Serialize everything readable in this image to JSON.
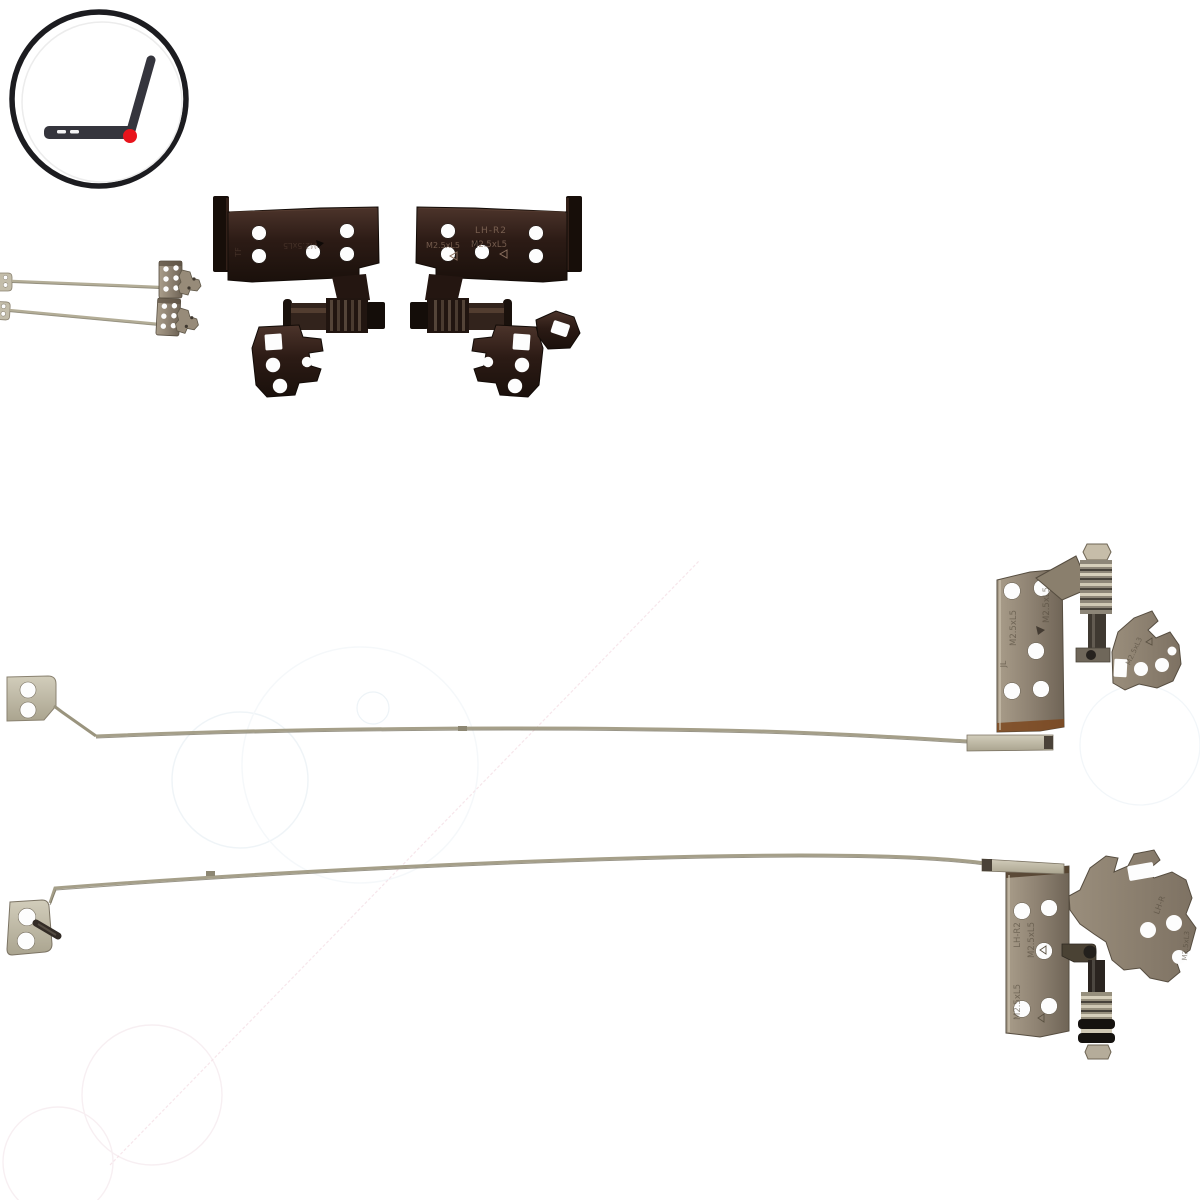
{
  "image": {
    "width": 1200,
    "height": 1200,
    "alt": "Product photo of a laptop LCD hinge and bracket rail set on white background"
  },
  "logo": {
    "name": "open-laptop-hinge-logo",
    "ring_color": "#1c1c20",
    "laptop_color": "#35353d",
    "hinge_dot_color": "#e8141c"
  },
  "colors": {
    "background": "#ffffff",
    "dark_hinge_base": "#2c1b15",
    "dark_hinge_edge": "#120b07",
    "dark_hinge_highlight": "#5d4134",
    "bronze": "#8e8272",
    "bronze_dark": "#564d40",
    "bronze_light": "#cfc6b2",
    "steel_light": "#c3bdaa",
    "rail_wire": "#a59f89",
    "copper_edge": "#7d481f",
    "hole_white": "#fdfdfd",
    "watermark_blue": "#e3ecf2",
    "watermark_pink": "#ecc9d4"
  },
  "markings": {
    "dark_left_code": "TF",
    "dark_left_screw": "M2.5xL5",
    "dark_right_model": "LH-R2",
    "dark_right_screw_a": "M2.5xL5",
    "dark_right_screw_b": "M2.5xL5",
    "rail_upper_screw_a": "M2.5xL5",
    "rail_upper_screw_b": "M2.5xL5",
    "rail_upper_code": "JL",
    "rail_upper_arm_screw": "M2.5xL3",
    "rail_lower_model": "LH-R2",
    "rail_lower_screw_a": "M2.5xL5",
    "rail_lower_screw_b": "M2.5xL5",
    "rail_lower_arm_code": "LH-R",
    "rail_lower_arm_screw": "M2.5xL3"
  },
  "parts": {
    "dark_hinge_left": "dark LCD hinge bracket, left",
    "dark_hinge_right": "dark LCD hinge bracket, right",
    "mini_hinge_top": "small hinge rail, top",
    "mini_hinge_bottom": "small hinge rail, bottom",
    "rail_upper": "long LCD hinge rail with bracket, upper",
    "rail_lower": "long LCD hinge rail with bracket, lower"
  }
}
